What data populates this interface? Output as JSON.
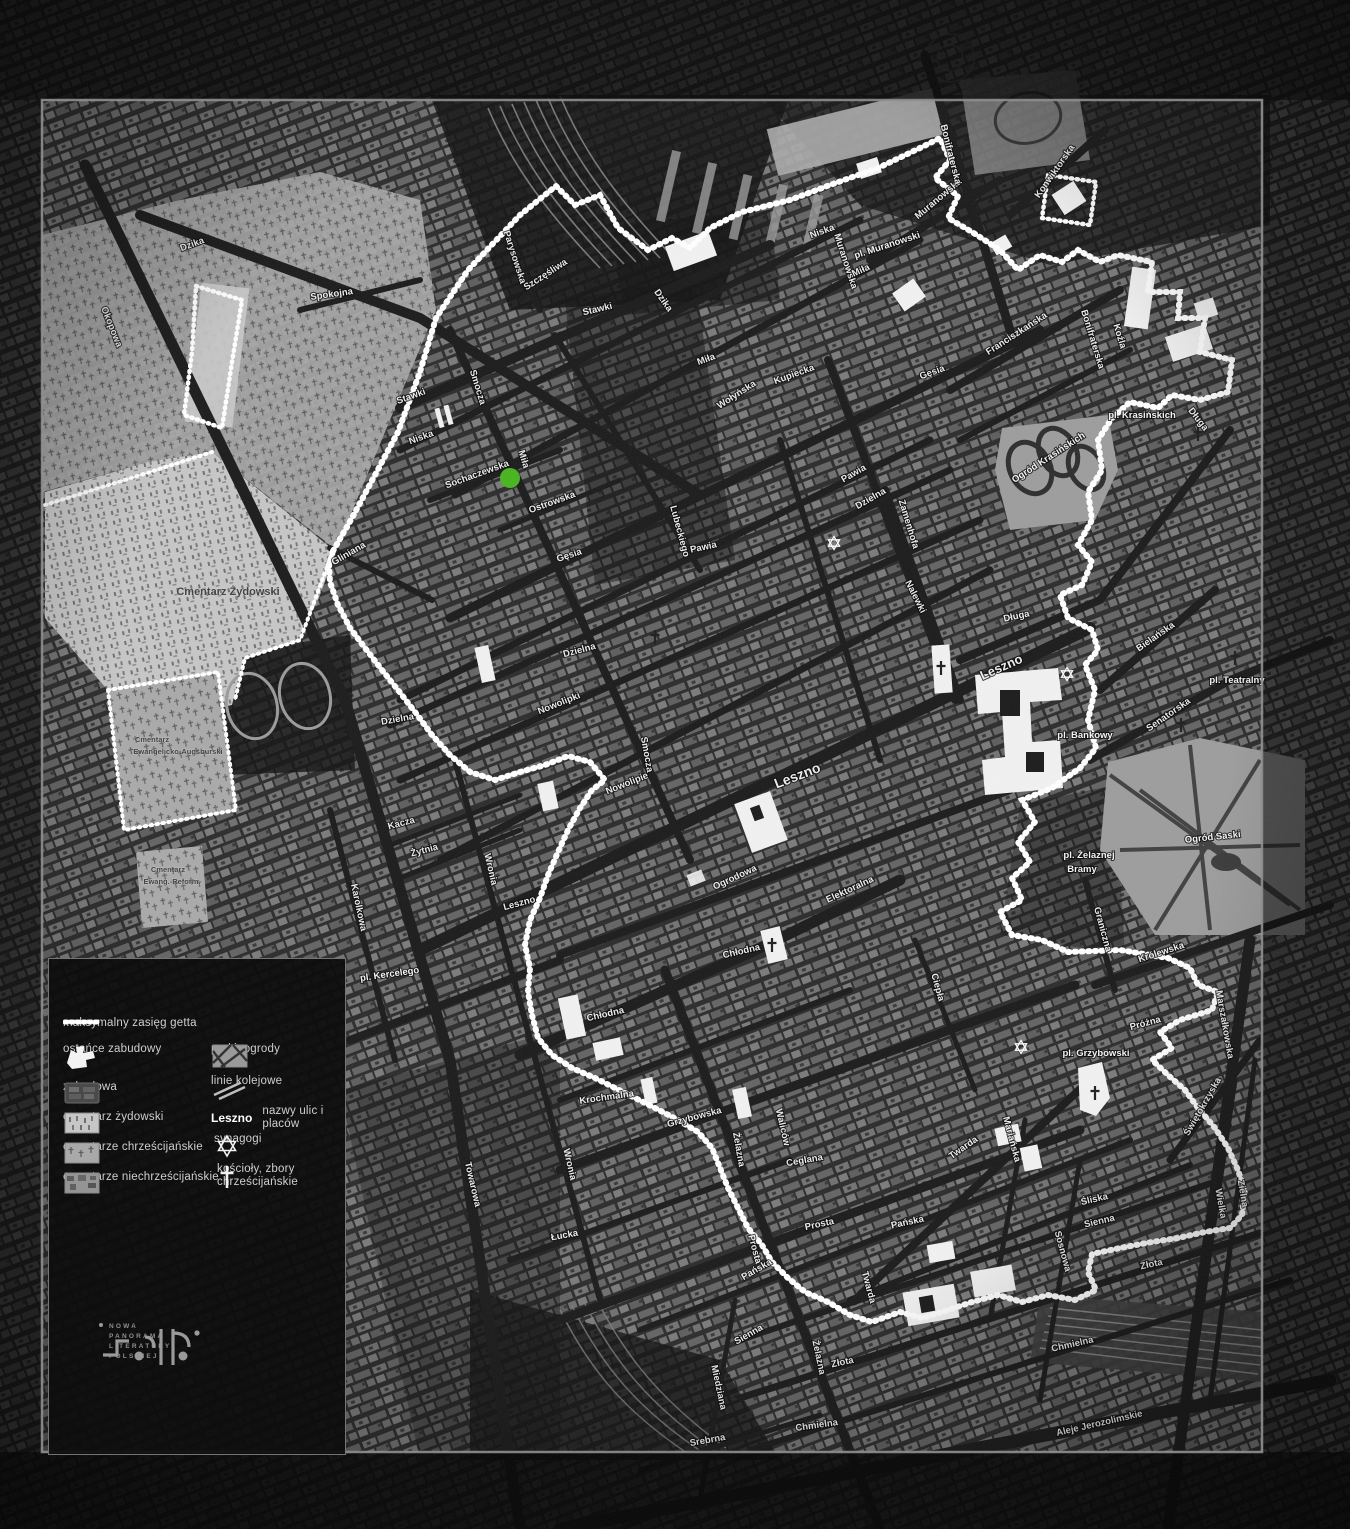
{
  "colors": {
    "background": "#0b0b0b",
    "fabric": "#7b7b7b",
    "roads": "#1a1a1a",
    "boundary": "#ffffff",
    "frame": "#8f8f8f",
    "cemetery_jewish": "#c6c6c6",
    "park": "#9c9c9c",
    "highlight_green": "#46b41e",
    "legend_text": "#cfcfcf"
  },
  "legend": {
    "items": [
      {
        "icon": "ghetto-boundary-dash",
        "label": "maksymalny zasięg getta"
      },
      {
        "icon": "remnant-shape",
        "label": "ostańce zabudowy"
      },
      {
        "icon": "built-up-swatch",
        "label": "zabudowa"
      },
      {
        "icon": "jewish-cemetery-swatch",
        "label": "cmentarz żydowski"
      },
      {
        "icon": "christian-cemetery-swatch",
        "label": "cmentarze chrześcijańskie"
      },
      {
        "icon": "non-christian-cemetery-swatch",
        "label": "cmentarze niechrześcijańskie"
      },
      {
        "icon": "park-swatch",
        "label": "parki, ogrody"
      },
      {
        "icon": "railway-swatch",
        "label": "linie kolejowe"
      },
      {
        "icon": "street-name-sample",
        "label": "nazwy ulic i placów",
        "example": "Leszno"
      },
      {
        "icon": "synagogue-star",
        "label": "synagogi"
      },
      {
        "icon": "church-cross",
        "label": "kościoły, zbory chrześcijańskie"
      }
    ]
  },
  "logo": {
    "lines": [
      "NOWA",
      "PANORAMA",
      "LITERATURY",
      "POLSKIEJ"
    ]
  },
  "map": {
    "labels": [
      {
        "t": "Dzika",
        "x": 193,
        "y": 247,
        "r": -20
      },
      {
        "t": "Okopowa",
        "x": 109,
        "y": 328,
        "r": 68
      },
      {
        "t": "Spokojna",
        "x": 332,
        "y": 297,
        "r": -8
      },
      {
        "t": "Parysowska",
        "x": 512,
        "y": 258,
        "r": 72
      },
      {
        "t": "Szczęśliwa",
        "x": 547,
        "y": 277,
        "r": -33
      },
      {
        "t": "Stawki",
        "x": 598,
        "y": 312,
        "r": -13
      },
      {
        "t": "Stawki",
        "x": 412,
        "y": 399,
        "r": -20
      },
      {
        "t": "Dzika",
        "x": 661,
        "y": 302,
        "r": 55
      },
      {
        "t": "Miła",
        "x": 707,
        "y": 362,
        "r": -20
      },
      {
        "t": "Niska",
        "x": 422,
        "y": 440,
        "r": -20
      },
      {
        "t": "Niska",
        "x": 823,
        "y": 234,
        "r": -20
      },
      {
        "t": "Smocza",
        "x": 475,
        "y": 388,
        "r": 73
      },
      {
        "t": "Smocza",
        "x": 644,
        "y": 755,
        "r": 80
      },
      {
        "t": "Sochaczewska",
        "x": 478,
        "y": 477,
        "r": -20
      },
      {
        "t": "Miła",
        "x": 521,
        "y": 460,
        "r": 73
      },
      {
        "t": "Lubeckiego",
        "x": 677,
        "y": 532,
        "r": 75
      },
      {
        "t": "Ostrowska",
        "x": 553,
        "y": 505,
        "r": -20
      },
      {
        "t": "Gęsia",
        "x": 570,
        "y": 558,
        "r": -18
      },
      {
        "t": "Gęsia",
        "x": 933,
        "y": 375,
        "r": -20
      },
      {
        "t": "Wołyńska",
        "x": 738,
        "y": 397,
        "r": -33
      },
      {
        "t": "Kupiecka",
        "x": 795,
        "y": 377,
        "r": -20
      },
      {
        "t": "Pawia",
        "x": 855,
        "y": 476,
        "r": -30
      },
      {
        "t": "Pawia",
        "x": 704,
        "y": 550,
        "r": -12
      },
      {
        "t": "Dzielna",
        "x": 872,
        "y": 501,
        "r": -30
      },
      {
        "t": "Dzielna",
        "x": 580,
        "y": 653,
        "r": -15
      },
      {
        "t": "Dzielna",
        "x": 398,
        "y": 722,
        "r": -10
      },
      {
        "t": "Zamenhofa",
        "x": 906,
        "y": 525,
        "r": 73
      },
      {
        "t": "Muranowska",
        "x": 940,
        "y": 201,
        "r": -40
      },
      {
        "t": "Muranowska",
        "x": 843,
        "y": 262,
        "r": 72
      },
      {
        "t": "pl. Muranowski",
        "x": 888,
        "y": 248,
        "r": -18,
        "c": "pl"
      },
      {
        "t": "Miła",
        "x": 862,
        "y": 273,
        "r": -25
      },
      {
        "t": "Konwiktorska",
        "x": 1057,
        "y": 173,
        "r": -55
      },
      {
        "t": "Bonifraterska",
        "x": 948,
        "y": 155,
        "r": 76
      },
      {
        "t": "Bonifraterska",
        "x": 1090,
        "y": 340,
        "r": 73
      },
      {
        "t": "Koźla",
        "x": 1117,
        "y": 337,
        "r": 73
      },
      {
        "t": "Franciszkańska",
        "x": 1018,
        "y": 336,
        "r": -33
      },
      {
        "t": "pl. Krasińskich",
        "x": 1142,
        "y": 418,
        "r": 0,
        "c": "pl"
      },
      {
        "t": "Długa",
        "x": 1196,
        "y": 421,
        "r": 52
      },
      {
        "t": "Długa",
        "x": 1017,
        "y": 619,
        "r": -12
      },
      {
        "t": "Nalewki",
        "x": 913,
        "y": 598,
        "r": 63
      },
      {
        "t": "Ogród Krasińskich",
        "x": 1050,
        "y": 460,
        "r": -33,
        "c": "pl"
      },
      {
        "t": "Bielańska",
        "x": 1157,
        "y": 639,
        "r": -35
      },
      {
        "t": "pl. Teatralny",
        "x": 1237,
        "y": 683,
        "r": 0,
        "c": "pl"
      },
      {
        "t": "Senatorska",
        "x": 1170,
        "y": 717,
        "r": -35
      },
      {
        "t": "pl. Bankowy",
        "x": 1085,
        "y": 738,
        "r": 0,
        "c": "pl"
      },
      {
        "t": "Ogród Saski",
        "x": 1213,
        "y": 840,
        "r": -6,
        "c": "pl"
      },
      {
        "t": "pl. Żelaznej",
        "x": 1089,
        "y": 858,
        "r": 0,
        "c": "pl"
      },
      {
        "t": "Bramy",
        "x": 1082,
        "y": 872,
        "r": 0,
        "c": "pl"
      },
      {
        "t": "Leszno",
        "x": 1003,
        "y": 671,
        "r": -24,
        "s": 13
      },
      {
        "t": "Leszno",
        "x": 799,
        "y": 780,
        "r": -21,
        "s": 14
      },
      {
        "t": "Leszno",
        "x": 520,
        "y": 906,
        "r": -15
      },
      {
        "t": "Nowolipie",
        "x": 628,
        "y": 786,
        "r": -22
      },
      {
        "t": "Nowolipki",
        "x": 560,
        "y": 706,
        "r": -22
      },
      {
        "t": "Kacza",
        "x": 402,
        "y": 826,
        "r": -15
      },
      {
        "t": "Żytnia",
        "x": 425,
        "y": 853,
        "r": -15
      },
      {
        "t": "Wronia",
        "x": 488,
        "y": 870,
        "r": 77
      },
      {
        "t": "Wronia",
        "x": 567,
        "y": 1165,
        "r": 77
      },
      {
        "t": "Ogrodowa",
        "x": 736,
        "y": 880,
        "r": -25
      },
      {
        "t": "Elektoralna",
        "x": 851,
        "y": 892,
        "r": -25
      },
      {
        "t": "Chłodna",
        "x": 742,
        "y": 954,
        "r": -13
      },
      {
        "t": "Chłodna",
        "x": 606,
        "y": 1017,
        "r": -13
      },
      {
        "t": "Krochmalna",
        "x": 607,
        "y": 1100,
        "r": -8
      },
      {
        "t": "Grzybowska",
        "x": 695,
        "y": 1120,
        "r": -15
      },
      {
        "t": "Żelazna",
        "x": 736,
        "y": 1150,
        "r": 80
      },
      {
        "t": "Żelazna",
        "x": 816,
        "y": 1358,
        "r": 78
      },
      {
        "t": "Ceglana",
        "x": 805,
        "y": 1163,
        "r": -10
      },
      {
        "t": "Waliców",
        "x": 780,
        "y": 1128,
        "r": 77
      },
      {
        "t": "Łucka",
        "x": 565,
        "y": 1238,
        "r": -10
      },
      {
        "t": "Towarowa",
        "x": 470,
        "y": 1185,
        "r": 77
      },
      {
        "t": "Prosta",
        "x": 820,
        "y": 1227,
        "r": -12
      },
      {
        "t": "Prosta",
        "x": 752,
        "y": 1250,
        "r": 75
      },
      {
        "t": "Pańska",
        "x": 908,
        "y": 1225,
        "r": -12
      },
      {
        "t": "Pańska",
        "x": 758,
        "y": 1272,
        "r": -30
      },
      {
        "t": "Twarda",
        "x": 866,
        "y": 1288,
        "r": 75
      },
      {
        "t": "Twarda",
        "x": 965,
        "y": 1150,
        "r": -35
      },
      {
        "t": "Ciepła",
        "x": 935,
        "y": 988,
        "r": 75
      },
      {
        "t": "Graniczna",
        "x": 1100,
        "y": 930,
        "r": 75
      },
      {
        "t": "Królewska",
        "x": 1162,
        "y": 955,
        "r": -18
      },
      {
        "t": "pl. Grzybowski",
        "x": 1096,
        "y": 1056,
        "r": 0,
        "c": "pl"
      },
      {
        "t": "Próżna",
        "x": 1146,
        "y": 1026,
        "r": -15
      },
      {
        "t": "Marszałkowska",
        "x": 1222,
        "y": 1025,
        "r": 80
      },
      {
        "t": "Świętokrzyska",
        "x": 1205,
        "y": 1108,
        "r": -60
      },
      {
        "t": "Mariańska",
        "x": 1009,
        "y": 1140,
        "r": 75
      },
      {
        "t": "Śliska",
        "x": 1095,
        "y": 1202,
        "r": -13
      },
      {
        "t": "Sienna",
        "x": 1100,
        "y": 1224,
        "r": -13
      },
      {
        "t": "Sienna",
        "x": 750,
        "y": 1337,
        "r": -30
      },
      {
        "t": "Złota",
        "x": 1152,
        "y": 1267,
        "r": -12
      },
      {
        "t": "Złota",
        "x": 843,
        "y": 1365,
        "r": -12
      },
      {
        "t": "Sosnowa",
        "x": 1060,
        "y": 1252,
        "r": 75
      },
      {
        "t": "Zielna",
        "x": 1240,
        "y": 1194,
        "r": 80
      },
      {
        "t": "Wielka",
        "x": 1218,
        "y": 1204,
        "r": 80
      },
      {
        "t": "Chmielna",
        "x": 1073,
        "y": 1347,
        "r": -13
      },
      {
        "t": "Chmielna",
        "x": 817,
        "y": 1428,
        "r": -8
      },
      {
        "t": "Aleje Jerozolimskie",
        "x": 1100,
        "y": 1426,
        "r": -13
      },
      {
        "t": "Miedziana",
        "x": 716,
        "y": 1388,
        "r": 78
      },
      {
        "t": "Srebrna",
        "x": 708,
        "y": 1443,
        "r": -10
      },
      {
        "t": "Gliniana",
        "x": 350,
        "y": 556,
        "r": -30
      },
      {
        "t": "pl. Kercelego",
        "x": 390,
        "y": 977,
        "r": -8,
        "c": "pl"
      },
      {
        "t": "Karolkowa",
        "x": 356,
        "y": 908,
        "r": 78
      },
      {
        "t": "Cmentarz Żydowski",
        "x": 228,
        "y": 595,
        "r": 0,
        "c": "dark",
        "s": 11
      },
      {
        "t": "Cmentarz",
        "x": 152,
        "y": 742,
        "r": 0,
        "c": "dark",
        "s": 7.5
      },
      {
        "t": "Ewangelicko-Augsburski",
        "x": 178,
        "y": 754,
        "r": 0,
        "c": "dark",
        "s": 7.5
      },
      {
        "t": "Cmentarz",
        "x": 168,
        "y": 872,
        "r": 0,
        "c": "dark",
        "s": 7.5
      },
      {
        "t": "Ewang.-Reform.",
        "x": 172,
        "y": 884,
        "r": 0,
        "c": "dark",
        "s": 7.5
      }
    ],
    "markers": {
      "synagogues": [
        [
          834,
          543
        ],
        [
          1067,
          674
        ],
        [
          1021,
          1047
        ]
      ],
      "churches": [
        [
          655,
          637
        ],
        [
          772,
          945
        ],
        [
          941,
          668
        ],
        [
          1095,
          1093
        ],
        [
          1181,
          725
        ],
        [
          1235,
          658
        ],
        [
          1198,
          434
        ]
      ],
      "highlight_dot": {
        "x": 510,
        "y": 478,
        "r": 10,
        "color": "#46b41e"
      }
    }
  }
}
